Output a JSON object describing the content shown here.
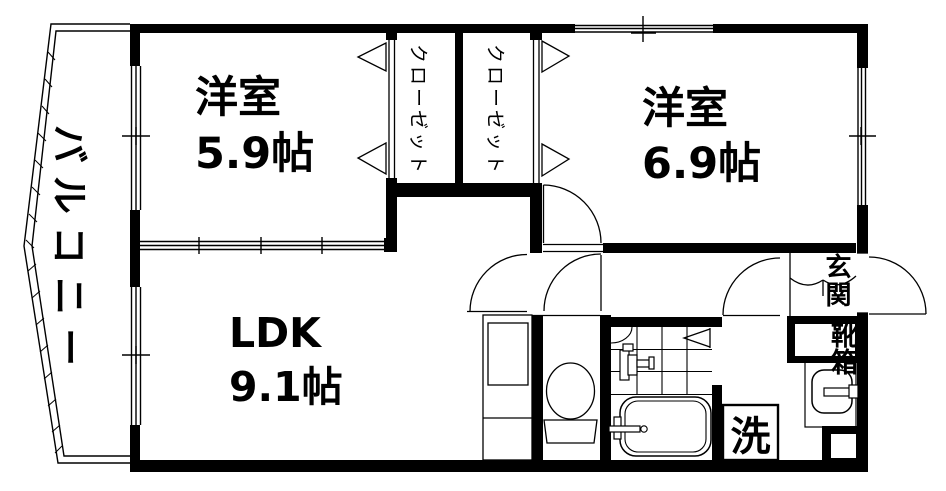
{
  "rooms": {
    "balcony": {
      "label": "バルコニー"
    },
    "bedroom1": {
      "name": "洋室",
      "size": "5.9帖"
    },
    "bedroom2": {
      "name": "洋室",
      "size": "6.9帖"
    },
    "ldk": {
      "name": "LDK",
      "size": "9.1帖"
    },
    "closet_left": {
      "label": "クローゼット"
    },
    "closet_right": {
      "label": "クローゼット"
    },
    "entrance": {
      "label": "玄関"
    },
    "shoe_box": {
      "label": "靴箱"
    },
    "laundry": {
      "label": "洗"
    }
  },
  "colors": {
    "line": "#000000",
    "background": "#ffffff"
  }
}
